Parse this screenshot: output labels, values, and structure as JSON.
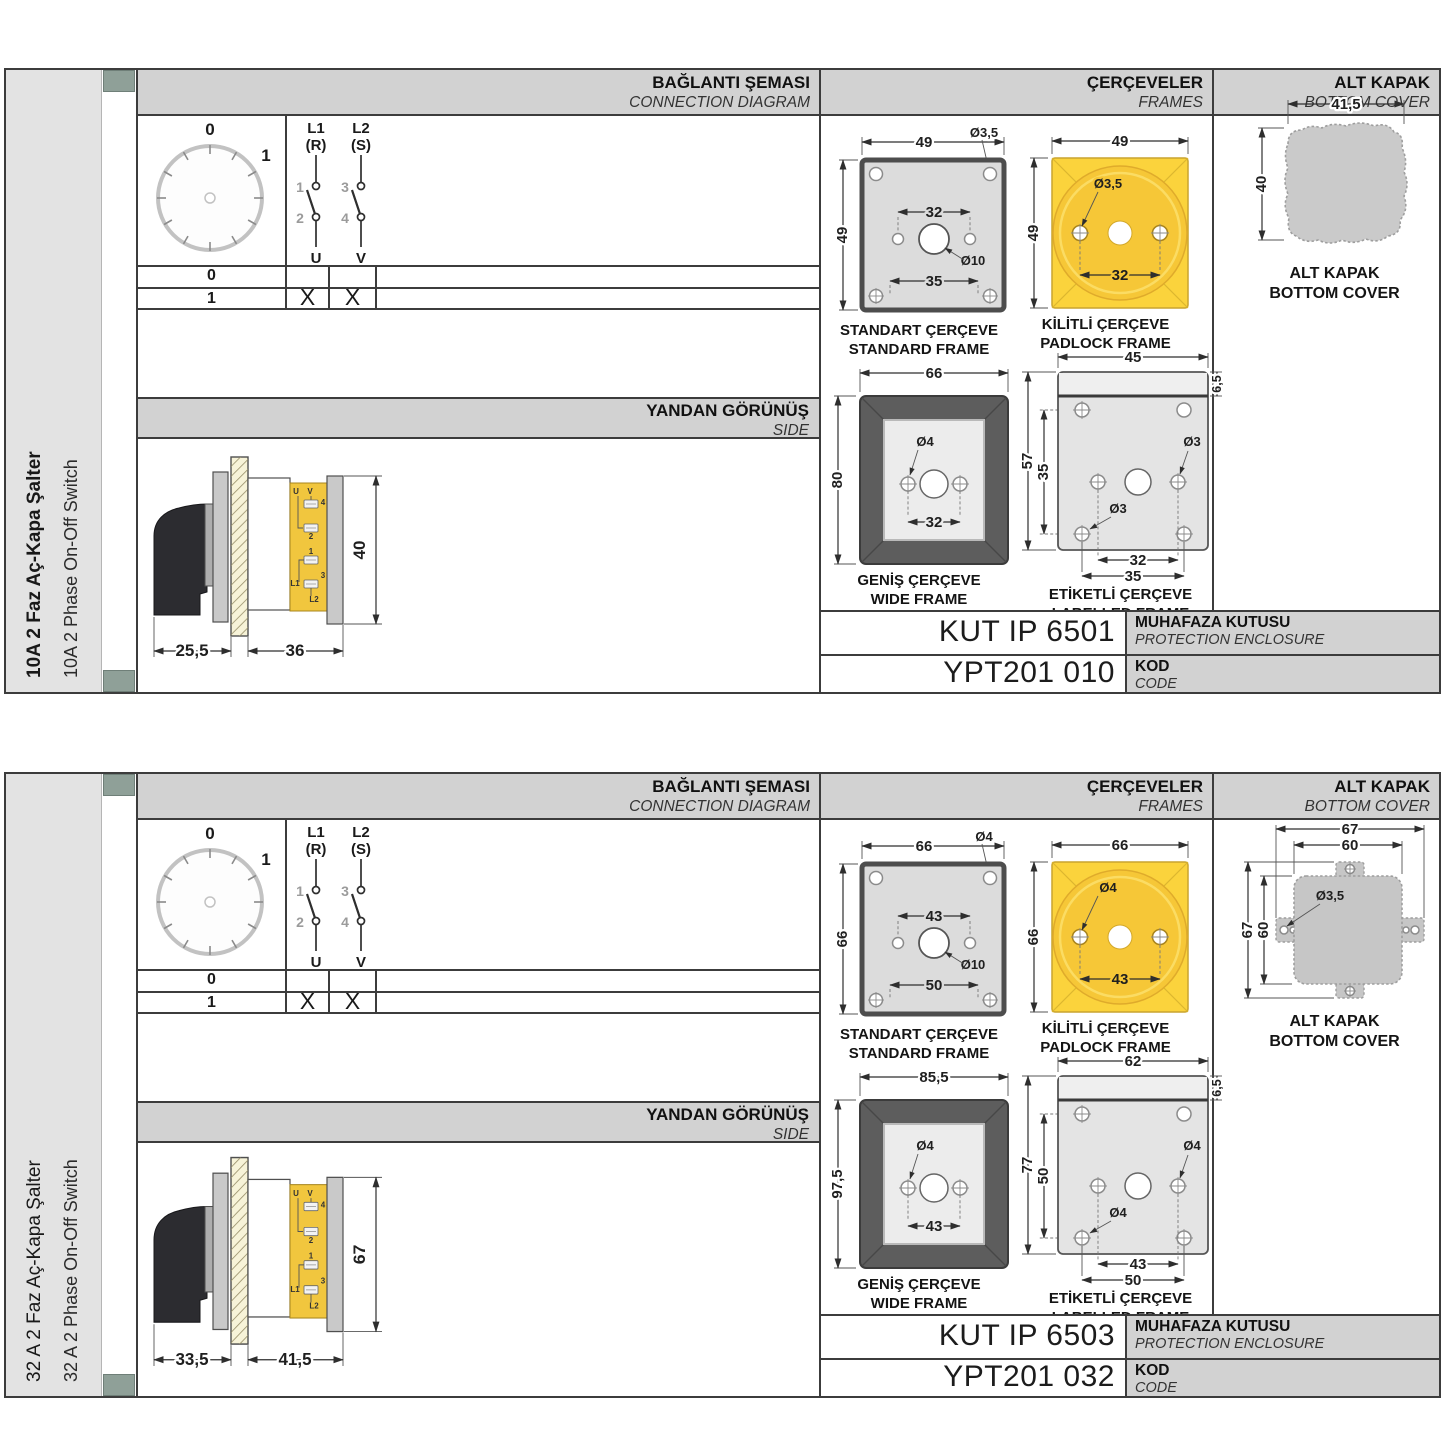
{
  "colors": {
    "accent_yellow": "#f6c737",
    "header_gray": "#d2d2d2",
    "line_dark": "#3c3c3c",
    "strip_mark_green": "#8fa098"
  },
  "panels": [
    {
      "title_tr": "10A 2 Faz Aç-Kapa Şalter",
      "title_en": "10A 2 Phase On-Off Switch",
      "hdr": {
        "conn_tr": "BAĞLANTI ŞEMASI",
        "conn_en": "CONNECTION DIAGRAM",
        "frames_tr": "ÇERÇEVELER",
        "frames_en": "FRAMES",
        "cover_tr": "ALT KAPAK",
        "cover_en": "BOTTOM COVER"
      },
      "dial": {
        "p0": "0",
        "p1": "1"
      },
      "poles": {
        "p1_top": "L1",
        "p1_sub": "(R)",
        "p1_in": "1",
        "p1_out": "2",
        "p1_bot": "U",
        "p2_top": "L2",
        "p2_sub": "(S)",
        "p2_in": "3",
        "p2_out": "4",
        "p2_bot": "V"
      },
      "table": {
        "r0_label": "0",
        "r1_label": "1",
        "r1_u": "X",
        "r1_v": "X"
      },
      "sideband": {
        "tr": "YANDAN GÖRÜNÜŞ",
        "en": "SIDE"
      },
      "side": {
        "d_left": "25,5",
        "d_right": "36",
        "d_h": "40",
        "t_u": "U",
        "t_v": "V",
        "t_4": "4",
        "t_2": "2",
        "t_1": "1",
        "t_3": "3",
        "t_l1": "L1",
        "t_l2": "L2"
      },
      "std": {
        "tr": "STANDART ÇERÇEVE",
        "en": "STANDARD FRAME",
        "w": "49",
        "h": "49",
        "hole": "Ø3,5",
        "inner": "32",
        "lower": "35",
        "center": "Ø10"
      },
      "pad": {
        "tr": "KİLİTLİ ÇERÇEVE",
        "en": "PADLOCK FRAME",
        "w": "49",
        "h": "49",
        "hole": "Ø3,5",
        "inner": "32"
      },
      "wide": {
        "tr": "GENİŞ ÇERÇEVE",
        "en": "WIDE FRAME",
        "w": "66",
        "h": "80",
        "hole": "Ø4",
        "inner": "32"
      },
      "lab": {
        "tr": "ETİKETLİ ÇERÇEVE",
        "en": "LABELLED FRAME",
        "w": "45",
        "strip": "6,5",
        "h": "57",
        "inner_v": "35",
        "hole_a": "Ø3",
        "hole_b": "Ø3",
        "inner": "32",
        "lower": "35"
      },
      "cover": {
        "tr": "ALT KAPAK",
        "en": "BOTTOM COVER",
        "w": "41,5",
        "h": "40"
      },
      "enc": {
        "value": "KUT IP 6501",
        "tr": "MUHAFAZA KUTUSU",
        "en": "PROTECTION ENCLOSURE"
      },
      "code": {
        "value": "YPT201 010",
        "tr": "KOD",
        "en": "CODE"
      }
    },
    {
      "title_tr": "32 A 2 Faz Aç-Kapa Şalter",
      "title_en": "32 A 2 Phase On-Off Switch",
      "hdr": {
        "conn_tr": "BAĞLANTI ŞEMASI",
        "conn_en": "CONNECTION DIAGRAM",
        "frames_tr": "ÇERÇEVELER",
        "frames_en": "FRAMES",
        "cover_tr": "ALT KAPAK",
        "cover_en": "BOTTOM COVER"
      },
      "dial": {
        "p0": "0",
        "p1": "1"
      },
      "poles": {
        "p1_top": "L1",
        "p1_sub": "(R)",
        "p1_in": "1",
        "p1_out": "2",
        "p1_bot": "U",
        "p2_top": "L2",
        "p2_sub": "(S)",
        "p2_in": "3",
        "p2_out": "4",
        "p2_bot": "V"
      },
      "table": {
        "r0_label": "0",
        "r1_label": "1",
        "r1_u": "X",
        "r1_v": "X"
      },
      "sideband": {
        "tr": "YANDAN GÖRÜNÜŞ",
        "en": "SIDE"
      },
      "side": {
        "d_left": "33,5",
        "d_right": "41,5",
        "d_h": "67",
        "t_u": "U",
        "t_v": "V",
        "t_4": "4",
        "t_2": "2",
        "t_1": "1",
        "t_3": "3",
        "t_l1": "L1",
        "t_l2": "L2"
      },
      "std": {
        "tr": "STANDART ÇERÇEVE",
        "en": "STANDARD FRAME",
        "w": "66",
        "h": "66",
        "hole": "Ø4",
        "inner": "43",
        "lower": "50",
        "center": "Ø10"
      },
      "pad": {
        "tr": "KİLİTLİ ÇERÇEVE",
        "en": "PADLOCK FRAME",
        "w": "66",
        "h": "66",
        "hole": "Ø4",
        "inner": "43"
      },
      "wide": {
        "tr": "GENİŞ ÇERÇEVE",
        "en": "WIDE FRAME",
        "w": "85,5",
        "h": "97,5",
        "hole": "Ø4",
        "inner": "43"
      },
      "lab": {
        "tr": "ETİKETLİ ÇERÇEVE",
        "en": "LABELLED FRAME",
        "w": "62",
        "strip": "6,5",
        "h": "77",
        "inner_v": "50",
        "hole_a": "Ø4",
        "hole_b": "Ø4",
        "inner": "43",
        "lower": "50"
      },
      "cover": {
        "tr": "ALT KAPAK",
        "en": "BOTTOM COVER",
        "w": "67",
        "w2": "60",
        "h": "67",
        "h2": "60",
        "hole": "Ø3,5"
      },
      "enc": {
        "value": "KUT IP 6503",
        "tr": "MUHAFAZA KUTUSU",
        "en": "PROTECTION ENCLOSURE"
      },
      "code": {
        "value": "YPT201 032",
        "tr": "KOD",
        "en": "CODE"
      }
    }
  ]
}
